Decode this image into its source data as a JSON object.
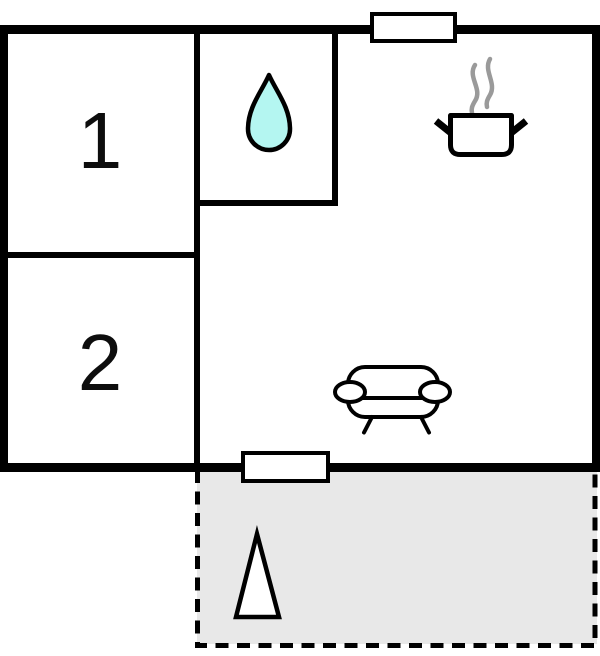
{
  "plan": {
    "rooms": [
      {
        "label": "1"
      },
      {
        "label": "2"
      }
    ]
  },
  "colors": {
    "wall": "#000000",
    "background": "#ffffff",
    "terrace_fill": "#e8e8e8",
    "water_drop_fill": "#b4f6f1",
    "steam_color": "#9a9a9a"
  },
  "icons": {
    "water_drop": "water-drop-icon",
    "steam": "steam-icon",
    "cooking_pot": "cooking-pot-icon",
    "sofa": "sofa-icon",
    "tree": "tree-icon",
    "window": "window-opening",
    "door": "door-opening"
  }
}
